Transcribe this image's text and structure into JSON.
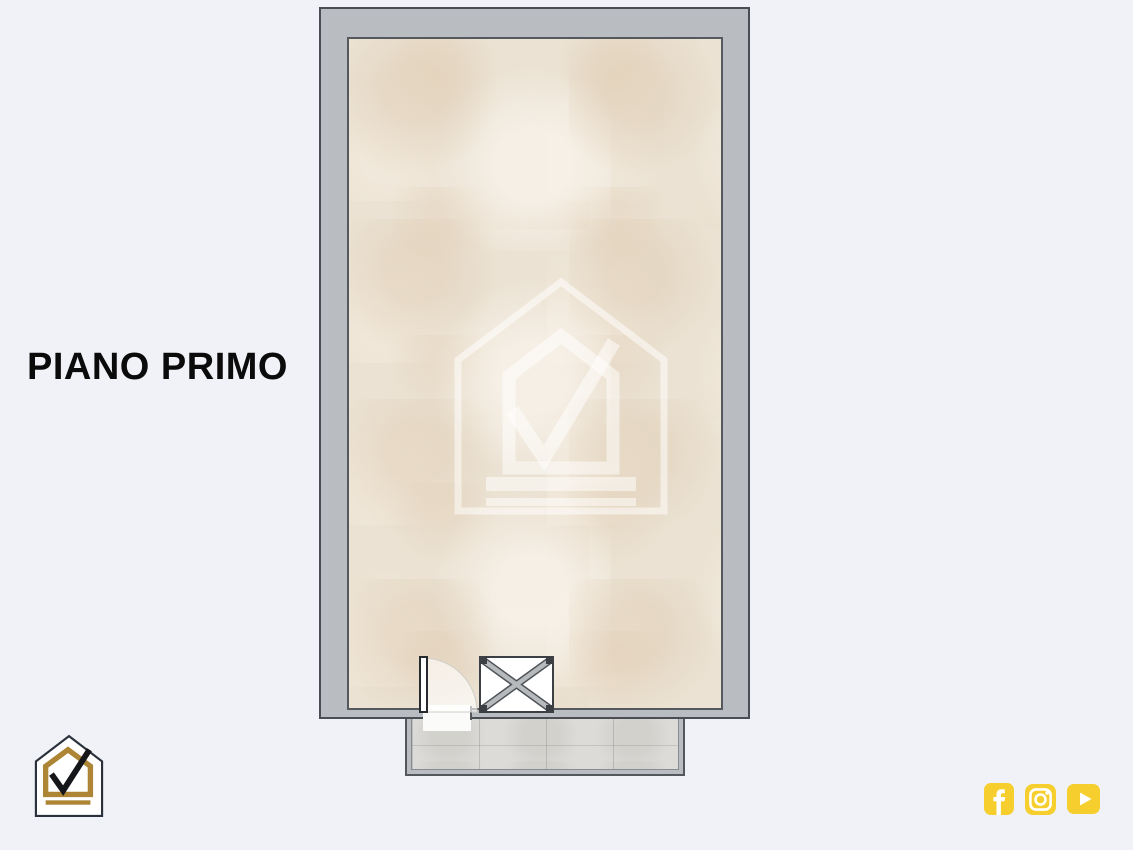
{
  "page": {
    "background": "#f0f2f7"
  },
  "plan": {
    "title": "PIANO PRIMO",
    "wall_fill": "#b9bdc2",
    "wall_line": "#4a4e54",
    "floor_fill": "#ebe2d3",
    "balcony_tile_fill": "#dcdbd8",
    "features": {
      "door": "hinged-door-with-swing-arc",
      "cross_box": "crossed-box-shaft",
      "balcony": "balcony-terrace"
    }
  },
  "branding": {
    "watermark": "house-check-watermark",
    "logo": "house-check-logo",
    "logo_gold": "#ad8534",
    "logo_outline": "#2a313c",
    "logo_check": "#14161a"
  },
  "social": {
    "accent": "#f6ce2e",
    "icons": [
      {
        "name": "facebook-icon"
      },
      {
        "name": "instagram-icon"
      },
      {
        "name": "youtube-icon"
      }
    ]
  }
}
